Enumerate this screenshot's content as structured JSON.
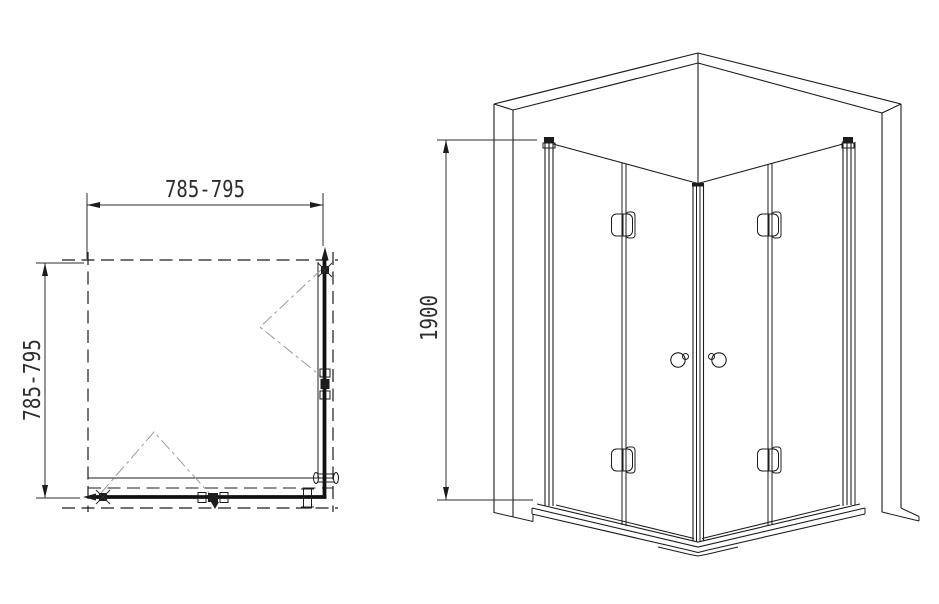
{
  "colors": {
    "background": "#ffffff",
    "line": "#1c1c1c",
    "fold_line": "#9a9a9a",
    "dimension_text": "#2e2e2e"
  },
  "plan_view": {
    "width_dimension": "785-795",
    "depth_dimension": "785-795"
  },
  "perspective_view": {
    "height_dimension": "1900"
  }
}
